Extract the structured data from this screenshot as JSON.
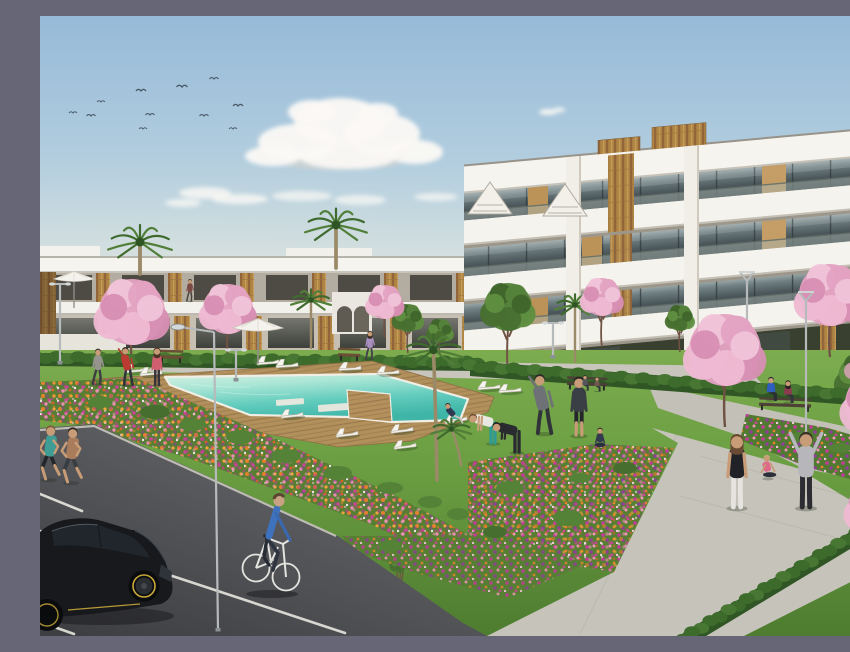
{
  "scene": {
    "kind": "residential-complex-3d-render",
    "visible_text": []
  },
  "palette": {
    "sky_top": "#96bad8",
    "sky_horizon": "#e9e9dd",
    "cloud": "#fbf9f5",
    "building_white": "#f5f3ed",
    "accent_wood": "#b08544",
    "glass": "#4c585c",
    "grass": "#699c41",
    "hedge": "#3c6b2c",
    "deck_wood": "#b3905c",
    "pool_water": "#62ccbd",
    "path_concrete": "#c6c3ba",
    "asphalt": "#55565a",
    "flower_orange": "#e5812e",
    "flower_magenta": "#c2449a",
    "blossom_pink": "#e3a2c2",
    "car": "#17191d",
    "rim": "#c9a93c",
    "bike": "#e3e3df",
    "cyclist_shirt": "#3f72bd",
    "jeans": "#2f3540",
    "skin": "#c79c77"
  },
  "clouds": [
    {
      "x": 300,
      "y": 143,
      "rx": 66,
      "ry": 11,
      "c": "#dfd3c8",
      "o": 0.5
    },
    {
      "x": 255,
      "y": 137,
      "rx": 38,
      "ry": 8,
      "c": "#e2d7cc",
      "o": 0.45
    },
    {
      "x": 258,
      "y": 126,
      "rx": 40,
      "ry": 18
    },
    {
      "x": 300,
      "y": 106,
      "rx": 46,
      "ry": 24
    },
    {
      "x": 342,
      "y": 118,
      "rx": 38,
      "ry": 20
    },
    {
      "x": 375,
      "y": 136,
      "rx": 28,
      "ry": 12
    },
    {
      "x": 233,
      "y": 140,
      "rx": 28,
      "ry": 10
    },
    {
      "x": 308,
      "y": 141,
      "rx": 48,
      "ry": 12
    },
    {
      "x": 272,
      "y": 96,
      "rx": 24,
      "ry": 12
    },
    {
      "x": 338,
      "y": 97,
      "rx": 20,
      "ry": 10
    },
    {
      "x": 165,
      "y": 177,
      "rx": 26,
      "ry": 6,
      "o": 0.8
    },
    {
      "x": 200,
      "y": 183,
      "rx": 28,
      "ry": 5,
      "o": 0.8
    },
    {
      "x": 143,
      "y": 187,
      "rx": 18,
      "ry": 4,
      "o": 0.75
    },
    {
      "x": 262,
      "y": 180,
      "rx": 30,
      "ry": 5,
      "o": 0.7
    },
    {
      "x": 320,
      "y": 184,
      "rx": 26,
      "ry": 5,
      "o": 0.7
    },
    {
      "x": 396,
      "y": 181,
      "rx": 22,
      "ry": 4,
      "o": 0.7
    },
    {
      "x": 447,
      "y": 187,
      "rx": 16,
      "ry": 3.5,
      "o": 0.65
    },
    {
      "x": 508,
      "y": 96,
      "rx": 9,
      "ry": 3,
      "o": 0.9
    },
    {
      "x": 519,
      "y": 94,
      "rx": 6,
      "ry": 2.5,
      "o": 0.85
    }
  ],
  "birds": [
    [
      33,
      97,
      0.8
    ],
    [
      51,
      100,
      0.9
    ],
    [
      61,
      86,
      0.8
    ],
    [
      101,
      75,
      1
    ],
    [
      110,
      99,
      0.9
    ],
    [
      103,
      113,
      0.8
    ],
    [
      142,
      71,
      1.1
    ],
    [
      164,
      100,
      0.9
    ],
    [
      174,
      63,
      0.9
    ],
    [
      193,
      113,
      0.8
    ],
    [
      198,
      90,
      1
    ]
  ],
  "hedges": [
    {
      "x1": -5,
      "y1": 337,
      "x2": 437,
      "y2": 342,
      "h": 13
    },
    {
      "x1": 430,
      "y1": 345,
      "x2": 852,
      "y2": 377,
      "h": 15
    },
    {
      "x1": 853,
      "y1": 490,
      "x2": 643,
      "y2": 617,
      "h": 17
    }
  ],
  "palms_back": [
    {
      "x": 100,
      "ty": 226,
      "by": 258,
      "r": 32
    },
    {
      "x": 296,
      "ty": 209,
      "by": 252,
      "r": 31
    },
    {
      "x": 271,
      "ty": 284,
      "by": 332,
      "r": 20
    },
    {
      "x": 535,
      "ty": 289,
      "by": 346,
      "r": 20
    },
    {
      "x": 835,
      "ty": 252,
      "by": 302,
      "r": 24
    }
  ],
  "palms_front": [
    {
      "x": 397,
      "ty": 334,
      "by": 464,
      "r": 30,
      "lean": -3
    },
    {
      "x": 421,
      "ty": 413,
      "by": 449,
      "r": 20,
      "lean": -8
    }
  ],
  "blossoms_back": [
    {
      "x": 92,
      "y": 296,
      "r": 33,
      "b": 346
    },
    {
      "x": 188,
      "y": 293,
      "r": 25,
      "b": 341
    },
    {
      "x": 345,
      "y": 286,
      "r": 17,
      "b": 321
    },
    {
      "x": 562,
      "y": 281,
      "r": 19,
      "b": 331
    },
    {
      "x": 790,
      "y": 279,
      "r": 31,
      "b": 341
    }
  ],
  "blossoms_front": [
    {
      "x": 685,
      "y": 334,
      "r": 36,
      "b": 411
    },
    {
      "x": 838,
      "y": 388,
      "r": 33,
      "b": 458
    },
    {
      "x": 836,
      "y": 491,
      "r": 28,
      "b": 556
    },
    {
      "x": 849,
      "y": 570,
      "r": 22,
      "b": 620
    }
  ],
  "green_trees": [
    {
      "x": 468,
      "y": 291,
      "r": 24,
      "b": 357
    },
    {
      "x": 368,
      "y": 302,
      "r": 14,
      "b": 337
    },
    {
      "x": 640,
      "y": 302,
      "r": 13,
      "b": 336
    },
    {
      "x": 822,
      "y": 362,
      "r": 24,
      "b": 420,
      "pink": true
    },
    {
      "x": 400,
      "y": 315,
      "r": 12,
      "b": 338
    },
    {
      "x": 360,
      "y": 548,
      "r": 9,
      "b": 600
    }
  ],
  "shrubs": [
    [
      115,
      396,
      15,
      7
    ],
    [
      152,
      409,
      13,
      6
    ],
    [
      200,
      421,
      14,
      7
    ],
    [
      246,
      440,
      15,
      7
    ],
    [
      60,
      386,
      12,
      6
    ],
    [
      298,
      457,
      14,
      7
    ],
    [
      350,
      472,
      13,
      6
    ],
    [
      390,
      486,
      12,
      6
    ],
    [
      418,
      498,
      11,
      6
    ],
    [
      470,
      472,
      14,
      7
    ],
    [
      528,
      502,
      15,
      8
    ],
    [
      455,
      516,
      12,
      6
    ],
    [
      585,
      452,
      12,
      6
    ],
    [
      540,
      462,
      11,
      5
    ],
    [
      760,
      421,
      11,
      5
    ],
    [
      800,
      432,
      11,
      5
    ],
    [
      92,
      432,
      10,
      5
    ],
    [
      135,
      452,
      11,
      5
    ],
    [
      350,
      530,
      12,
      6
    ]
  ],
  "loungers": [
    [
      228,
      346,
      -4
    ],
    [
      247,
      349,
      -4
    ],
    [
      310,
      352,
      -3
    ],
    [
      348,
      356,
      -3
    ],
    [
      95,
      354,
      -5
    ],
    [
      111,
      357,
      -5
    ],
    [
      307,
      418,
      -7
    ],
    [
      362,
      414,
      -7
    ],
    [
      365,
      430,
      -7
    ],
    [
      252,
      399,
      -6
    ],
    [
      449,
      371,
      -4
    ],
    [
      470,
      374,
      -4
    ],
    [
      416,
      404,
      -10
    ]
  ],
  "parasols": [
    [
      34,
      263,
      0.85
    ],
    [
      218,
      312,
      1.05
    ]
  ],
  "benches": [
    {
      "x": 131,
      "y": 343,
      "w": 24,
      "c": "#6b4f34"
    },
    {
      "x": 309,
      "y": 341,
      "w": 22,
      "c": "#6b4f34"
    },
    {
      "x": 547,
      "y": 370,
      "w": 40,
      "c": "#4a4038"
    },
    {
      "x": 745,
      "y": 391,
      "w": 52,
      "c": "#4e4236"
    }
  ],
  "lamps": [
    {
      "x": 20,
      "t": 268,
      "b": 347,
      "s": "T"
    },
    {
      "x": 178,
      "t": 316,
      "b": 614,
      "s": "A",
      "lean": -4
    },
    {
      "x": 196,
      "t": 334,
      "b": 364,
      "s": "T"
    },
    {
      "x": 766,
      "t": 285,
      "b": 441,
      "s": "V"
    },
    {
      "x": 707,
      "t": 265,
      "b": 311,
      "s": "V"
    },
    {
      "x": 513,
      "t": 307,
      "b": 341,
      "s": "T"
    }
  ],
  "parking_lines": [
    [
      0,
      478,
      42,
      495
    ],
    [
      0,
      515,
      88,
      533
    ],
    [
      108,
      552,
      305,
      617
    ],
    [
      0,
      606,
      34,
      618
    ]
  ],
  "people": [
    {
      "name": "jogger-woman",
      "x": 9,
      "y": 463,
      "h": 52,
      "shirt": "#3f9d95",
      "pants": "#24272c",
      "pose": "jog",
      "hair": "#7a5a3c",
      "arms": "skin",
      "shorts": true
    },
    {
      "name": "jogger-man",
      "x": 31,
      "y": 466,
      "h": 53,
      "shirt": "#a97c5c",
      "pants": "#383d42",
      "pose": "jog",
      "hair": "#2e2722",
      "arms": "skin",
      "shorts": true
    },
    {
      "name": "walker-grey",
      "x": 58,
      "y": 368,
      "h": 34,
      "shirt": "#97948e",
      "pants": "#3b3d41",
      "pose": "walk",
      "hair": "#33302b"
    },
    {
      "name": "stretching-man-red",
      "x": 88,
      "y": 369,
      "h": 36,
      "shirt": "#bb3b33",
      "pants": "#303438",
      "pose": "stretch",
      "hair": "#23201c"
    },
    {
      "name": "woman-pink",
      "x": 117,
      "y": 369,
      "h": 36,
      "shirt": "#cf5f6e",
      "pants": "#38333a",
      "pose": "stand",
      "hair": "#4a3526",
      "long": true
    },
    {
      "name": "walker-upper",
      "x": 150,
      "y": 285,
      "h": 21,
      "shirt": "#7c4a44",
      "pants": "#45423f",
      "pose": "walk",
      "hair": "#2e2722"
    },
    {
      "name": "walker-purple",
      "x": 330,
      "y": 343,
      "h": 27,
      "shirt": "#a98fc0",
      "pants": "#44414a",
      "pose": "walk",
      "hair": "#3c2e24",
      "long": true
    },
    {
      "name": "lounging-person",
      "x": 414,
      "y": 408,
      "h": 30,
      "shirt": "#2e3a52",
      "pants": "#c8c2b6",
      "pose": "recline",
      "hair": "#2a2622"
    },
    {
      "name": "exerciser-teal-leggings",
      "x": 453,
      "y": 427,
      "h": 46,
      "shirt": "#e9e7e2",
      "pants": "#2f9b95",
      "pose": "bend",
      "hair": "#6b4a2e",
      "arms": "skin"
    },
    {
      "name": "exerciser-black",
      "x": 477,
      "y": 436,
      "h": 47,
      "shirt": "#292b30",
      "pants": "#292b30",
      "pose": "bend",
      "hair": "#1f1e1c"
    },
    {
      "name": "stretcher-grey",
      "x": 504,
      "y": 417,
      "h": 56,
      "shirt": "#6e7176",
      "pants": "#303338",
      "pose": "stretch",
      "hair": "#2d2a26"
    },
    {
      "name": "man-standing",
      "x": 539,
      "y": 419,
      "h": 56,
      "shirt": "#3a3e45",
      "pants": "#24262b",
      "pose": "stand",
      "hair": "#23211e",
      "shorts": true
    },
    {
      "name": "yoga-woman",
      "x": 560,
      "y": 431,
      "h": 33,
      "shirt": "#333a4e",
      "pants": "#2b3040",
      "pose": "yoga",
      "hair": "#33281f"
    },
    {
      "name": "bench-sitter-a",
      "x": 545,
      "y": 374,
      "h": 21,
      "shirt": "#54575d",
      "pants": "#35383c",
      "pose": "sit",
      "hair": "#2c2a27"
    },
    {
      "name": "bench-sitter-b",
      "x": 557,
      "y": 375,
      "h": 20,
      "shirt": "#6e5a4e",
      "pants": "#303338",
      "pose": "sit",
      "hair": "#3c332a"
    },
    {
      "name": "bench-man-blue",
      "x": 731,
      "y": 384,
      "h": 33,
      "shirt": "#2e5ec0",
      "pants": "#2b2e33",
      "pose": "sit",
      "hair": "#20252e"
    },
    {
      "name": "bench-woman",
      "x": 748,
      "y": 386,
      "h": 31,
      "shirt": "#8c3a4e",
      "pants": "#32353a",
      "pose": "sit",
      "hair": "#23201d",
      "long": true
    },
    {
      "name": "woman-white-pants",
      "x": 697,
      "y": 491,
      "h": 70,
      "shirt": "#202228",
      "pants": "#e6e4e0",
      "pose": "stand",
      "hair": "#6b4a34",
      "long": true,
      "arms": "skin"
    },
    {
      "name": "sitting-exerciser-pink",
      "x": 728,
      "y": 462,
      "h": 38,
      "shirt": "#e0688a",
      "pants": "#2d3038",
      "pose": "sitback",
      "hair": "#caa97e",
      "arms": "skin"
    },
    {
      "name": "exerciser-arms-up",
      "x": 766,
      "y": 491,
      "h": 72,
      "shirt": "#b7b7bb",
      "pants": "#2b2d33",
      "pose": "armsup",
      "hair": "#3a332c"
    }
  ]
}
